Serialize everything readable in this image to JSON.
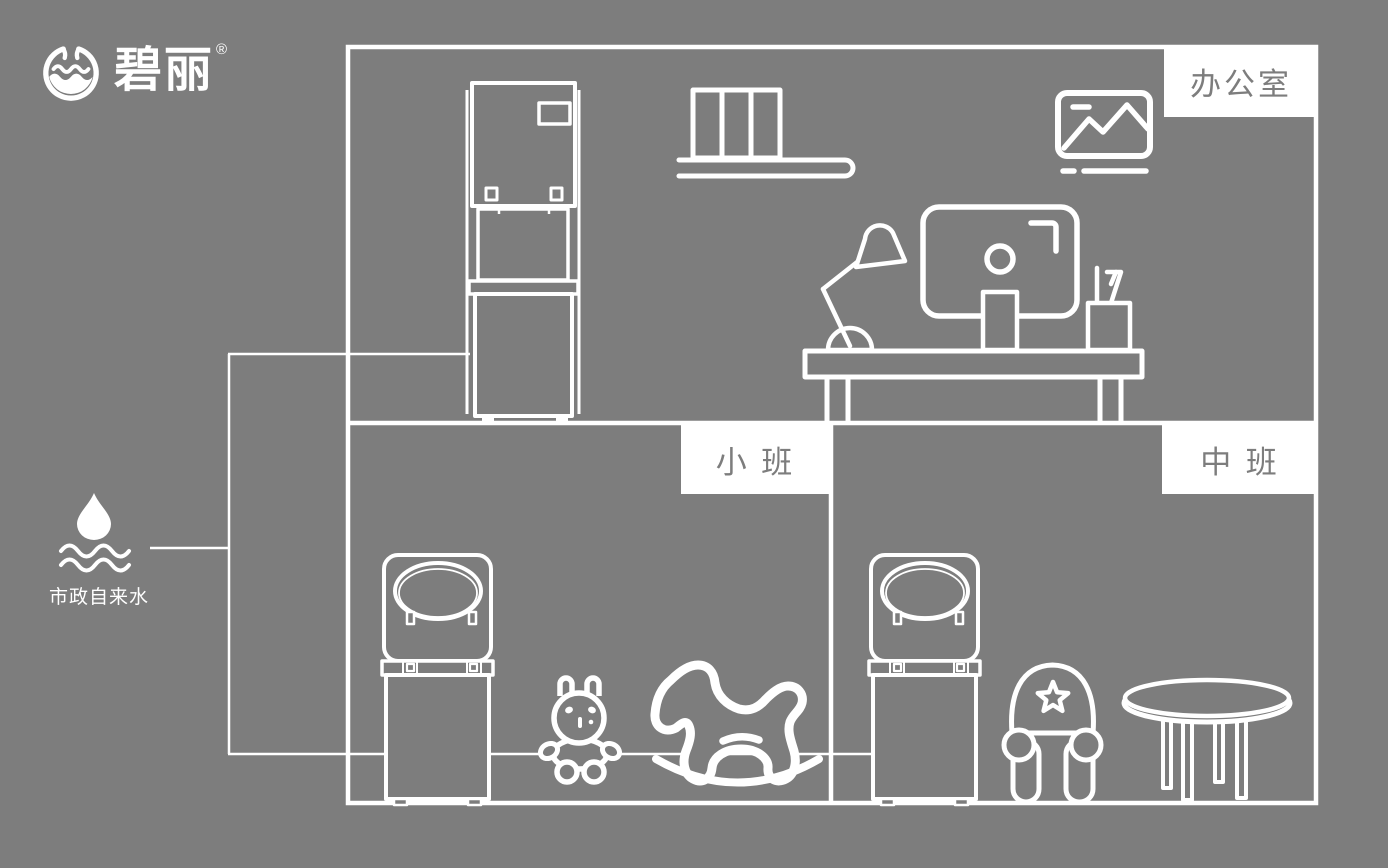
{
  "canvas": {
    "background_color": "#7d7d7d",
    "line_color": "#ffffff",
    "label_background": "#ffffff",
    "label_text_color": "#7d7d7d"
  },
  "brand": {
    "name": "碧丽",
    "registered": "®",
    "logo_icon": "water-cup-logo-icon"
  },
  "rooms": {
    "office": {
      "label": "办公室"
    },
    "junior_class": {
      "label": "小 班"
    },
    "middle_class": {
      "label": "中 班"
    }
  },
  "water_source": {
    "label": "市政自来水",
    "icon": "water-drop-over-waves-icon"
  },
  "icons": {
    "office_equipment": [
      "vertical-water-dispenser-icon",
      "bookshelf-icon",
      "picture-frame-icon",
      "desk-lamp-icon",
      "computer-monitor-icon",
      "pen-holder-icon",
      "office-desk-icon"
    ],
    "junior_class_equipment": [
      "child-water-dispenser-icon",
      "toy-rabbit-icon",
      "rocking-horse-icon"
    ],
    "middle_class_equipment": [
      "child-water-dispenser-icon",
      "kids-chair-icon",
      "round-table-icon"
    ]
  }
}
